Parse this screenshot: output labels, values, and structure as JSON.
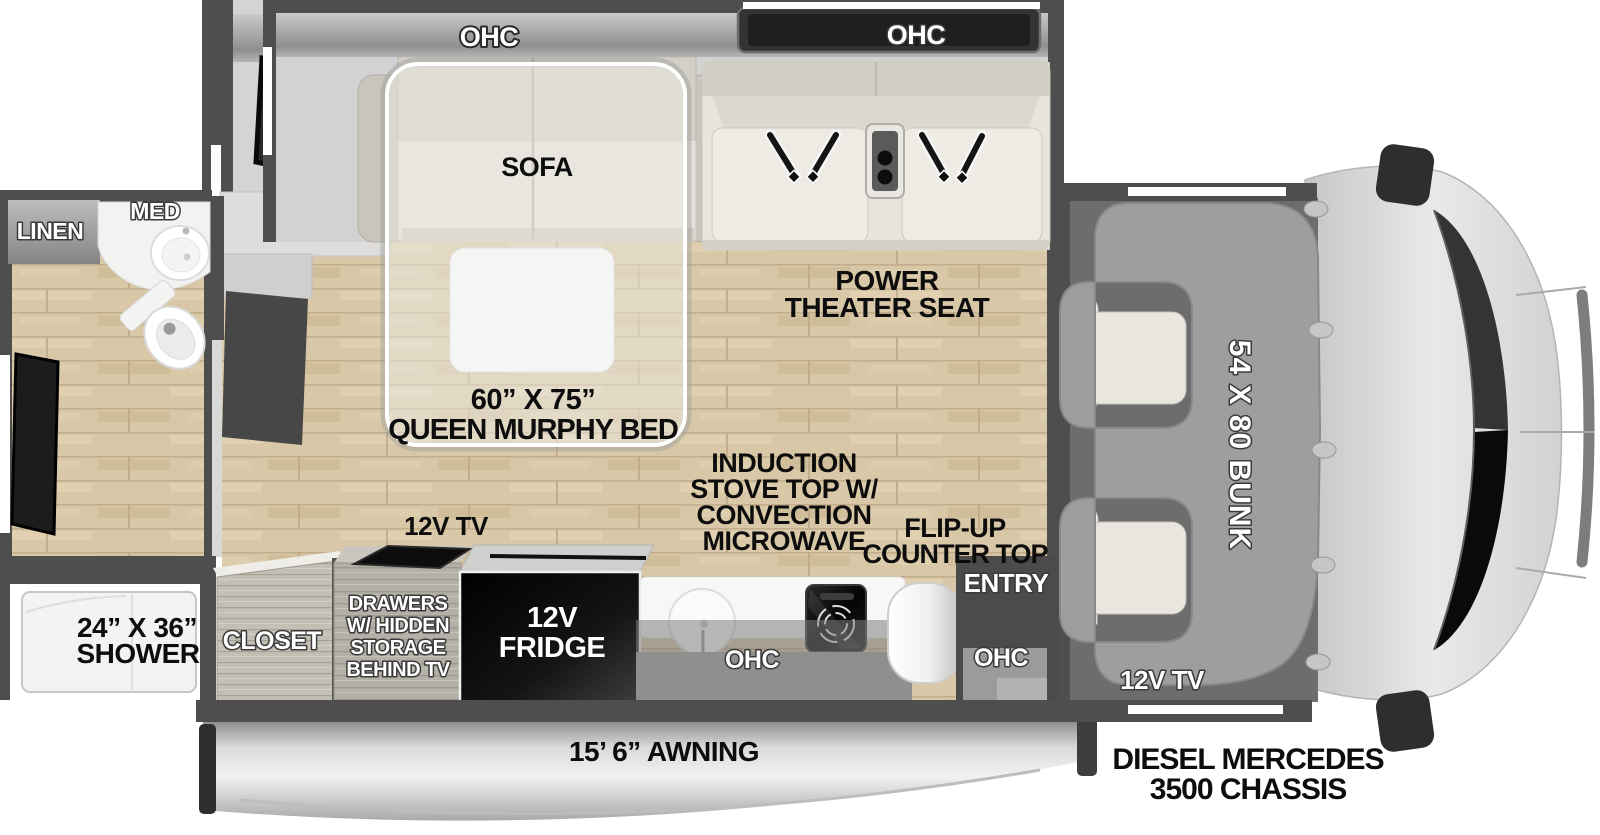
{
  "palette": {
    "wall": "#4e4e4e",
    "floor_wood": "#d9c8a7",
    "fabric": "#e6e3dc",
    "counter_white": "#f6f6f5",
    "appliance_black": "#0d0d0d",
    "bunk_gray": "#9e9e9e",
    "cab_gray": "#d9d9d9",
    "awning_silver": "#dcdcdc",
    "label_dark": "#0d0d0d",
    "label_light": "#ffffff"
  },
  "slideout_top": {
    "ohc_left": "OHC",
    "ohc_right": "OHC",
    "sofa": "SOFA",
    "theater_1": "POWER",
    "theater_2": "THEATER SEAT"
  },
  "bedroom": {
    "murphy_size": "60” X 75”",
    "murphy_name": "QUEEN MURPHY BED"
  },
  "bathroom": {
    "linen": "LINEN",
    "med": "MED",
    "shower_size": "24” X 36”",
    "shower_name": "SHOWER"
  },
  "kitchen": {
    "closet": "CLOSET",
    "tv": "12V TV",
    "drawers_1": "DRAWERS",
    "drawers_2": "W/ HIDDEN",
    "drawers_3": "STORAGE",
    "drawers_4": "BEHIND TV",
    "fridge_1": "12V",
    "fridge_2": "FRIDGE",
    "induction_1": "INDUCTION",
    "induction_2": "STOVE TOP W/",
    "induction_3": "CONVECTION",
    "induction_4": "MICROWAVE",
    "flipup_1": "FLIP-UP",
    "flipup_2": "COUNTER TOP",
    "ohc_counter": "OHC"
  },
  "entry": {
    "label": "ENTRY",
    "ohc": "OHC"
  },
  "cab": {
    "bunk": "54 X 80 BUNK",
    "tv": "12V TV",
    "chassis_1": "DIESEL MERCEDES",
    "chassis_2": "3500 CHASSIS"
  },
  "exterior": {
    "awning": "15’ 6” AWNING"
  }
}
